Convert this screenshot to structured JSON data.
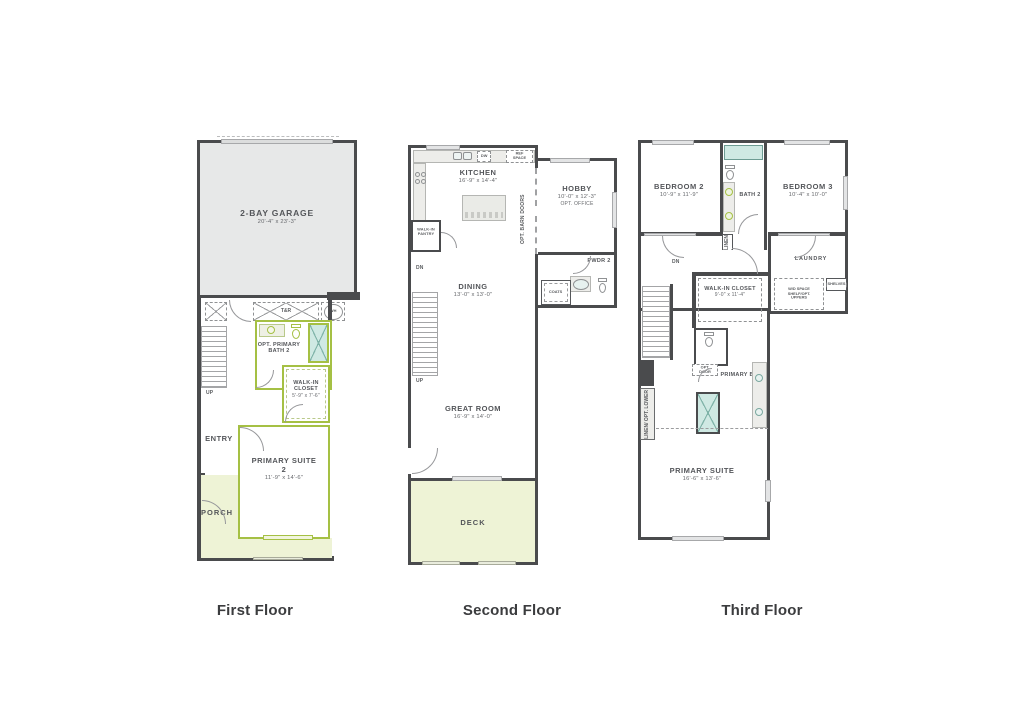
{
  "colors": {
    "wall": "#4a4b4d",
    "garage_fill": "#e7e8e8",
    "outdoor_fill": "#eef3d6",
    "highlight_green": "#a5c044",
    "fixture_teal": "#cfe9e3"
  },
  "floors": [
    {
      "title": "First Floor",
      "rooms": {
        "garage": {
          "name": "2-BAY GARAGE",
          "dims": "20'-4\" x 23'-3\""
        },
        "opt_primary_bath": {
          "name": "OPT. PRIMARY BATH 2"
        },
        "walk_in_closet": {
          "name": "WALK-IN CLOSET",
          "dims": "5'-9\" x 7'-6\""
        },
        "entry": {
          "name": "ENTRY"
        },
        "primary_suite": {
          "name": "PRIMARY SUITE 2",
          "dims": "11'-9\" x 14'-6\""
        },
        "porch": {
          "name": "PORCH"
        }
      },
      "labels": {
        "tandr": "T&R",
        "wh": "WH",
        "up": "UP"
      }
    },
    {
      "title": "Second Floor",
      "rooms": {
        "kitchen": {
          "name": "KITCHEN",
          "dims": "16'-9\" x 14'-4\""
        },
        "pantry": {
          "name": "WALK-IN PANTRY"
        },
        "hobby": {
          "name": "HOBBY",
          "dims": "10'-0\" x 12'-3\"",
          "note": "OPT. OFFICE"
        },
        "dining": {
          "name": "DINING",
          "dims": "13'-0\" x 13'-0\""
        },
        "great_room": {
          "name": "GREAT ROOM",
          "dims": "16'-9\" x 14'-0\""
        },
        "pwdr": {
          "name": "PWDR 2"
        },
        "coats": {
          "name": "COATS"
        },
        "deck": {
          "name": "DECK"
        }
      },
      "labels": {
        "dw": "DW",
        "ref": "REF SPACE",
        "barn_doors": "OPT. BARN DOORS",
        "dn": "DN",
        "up": "UP"
      }
    },
    {
      "title": "Third Floor",
      "rooms": {
        "bedroom2": {
          "name": "BEDROOM 2",
          "dims": "10'-9\" x 11'-9\""
        },
        "bath2": {
          "name": "BATH 2"
        },
        "bedroom3": {
          "name": "BEDROOM 3",
          "dims": "10'-4\" x 10'-0\""
        },
        "laundry": {
          "name": "LAUNDRY"
        },
        "walk_in_closet": {
          "name": "WALK-IN CLOSET",
          "dims": "9'-0\" x 11'-4\""
        },
        "primary_bath": {
          "name": "PRIMARY BATH"
        },
        "primary_suite": {
          "name": "PRIMARY SUITE",
          "dims": "16'-6\" x 13'-6\""
        }
      },
      "labels": {
        "linen": "LINEN",
        "wd_space": "W/D SPACE SHELF/OPT. UPPERS",
        "shelves": "SHELVES",
        "opt_door": "OPT. DOOR",
        "linen_opt_lower": "LINEN/ OPT. LOWER",
        "dn": "DN"
      }
    }
  ]
}
